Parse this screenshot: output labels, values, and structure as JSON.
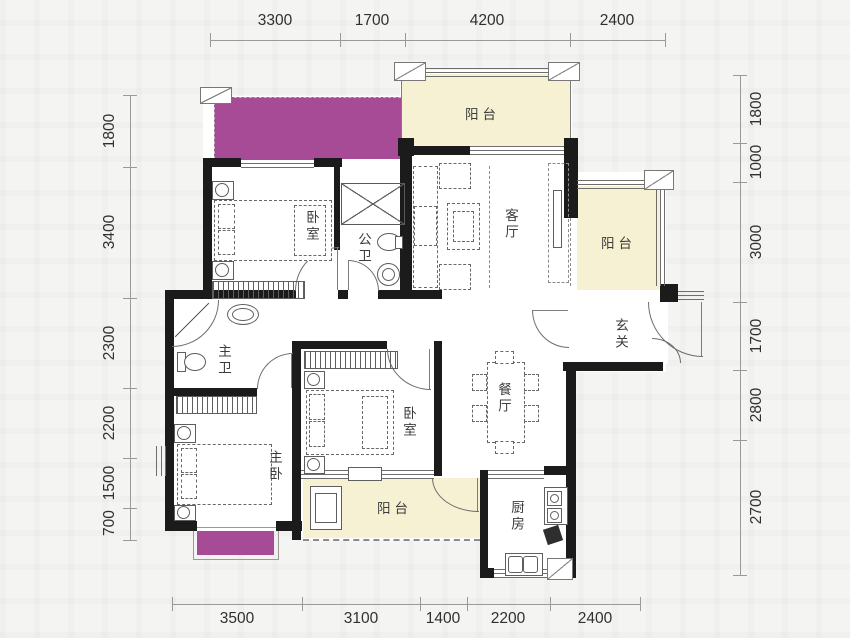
{
  "rooms": {
    "balcony_top": "阳台",
    "living": "客厅",
    "balcony_right": "阳台",
    "foyer": "玄关",
    "bedroom1": "卧室",
    "bath_public": "公卫",
    "bath_master": "主卫",
    "dining": "餐厅",
    "bedroom2": "卧室",
    "bedroom_master": "主卧",
    "balcony_bottom": "阳台",
    "kitchen": "厨房"
  },
  "dimensions": {
    "top": [
      "3300",
      "1700",
      "4200",
      "2400"
    ],
    "bottom": [
      "3500",
      "3100",
      "1400",
      "2200",
      "2400"
    ],
    "left": [
      "1800",
      "3400",
      "2300",
      "2200",
      "1500",
      "700"
    ],
    "right": [
      "1800",
      "1000",
      "3000",
      "1700",
      "2800",
      "2700"
    ]
  },
  "colors": {
    "balcony_fill": "#f6f1d2",
    "highlight_fill": "#a84b96",
    "wall": "#1b1b1b"
  }
}
